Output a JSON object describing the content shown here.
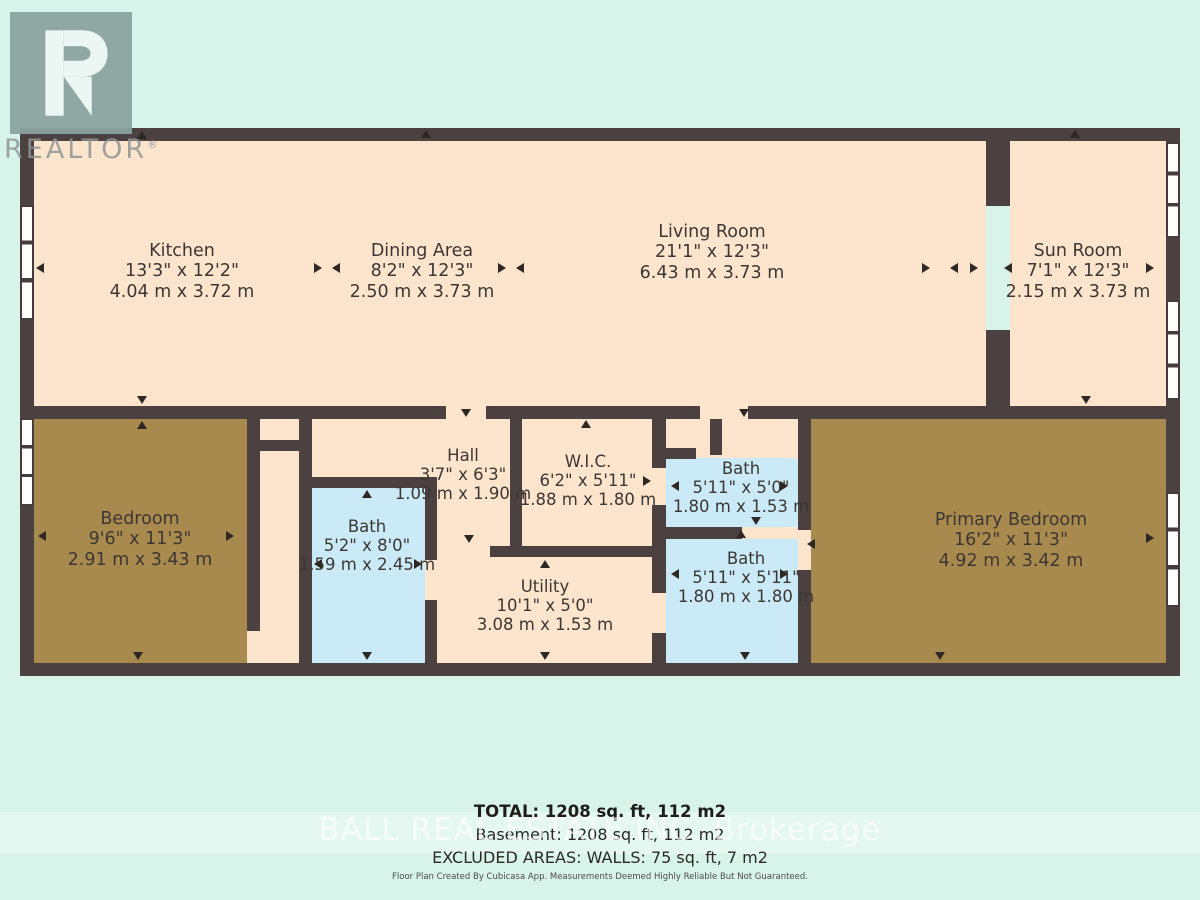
{
  "branding": {
    "logo_text": "R",
    "logo_label": "REALTOR",
    "logo_reg": "®",
    "watermark": "BALL REAL ESTATE INC. Brokerage"
  },
  "rooms": [
    {
      "name": "Kitchen",
      "imperial": "13'3\" x 12'2\"",
      "metric": "4.04 m x 3.72 m"
    },
    {
      "name": "Dining Area",
      "imperial": "8'2\" x 12'3\"",
      "metric": "2.50 m x 3.73 m"
    },
    {
      "name": "Living Room",
      "imperial": "21'1\" x 12'3\"",
      "metric": "6.43 m x 3.73 m"
    },
    {
      "name": "Sun Room",
      "imperial": "7'1\" x 12'3\"",
      "metric": "2.15 m x 3.73 m"
    },
    {
      "name": "Bedroom",
      "imperial": "9'6\" x 11'3\"",
      "metric": "2.91 m x 3.43 m"
    },
    {
      "name": "Hall",
      "imperial": "3'7\" x 6'3\"",
      "metric": "1.09 m x 1.90 m"
    },
    {
      "name": "W.I.C.",
      "imperial": "6'2\" x 5'11\"",
      "metric": "1.88 m x 1.80 m"
    },
    {
      "name": "Bath",
      "imperial": "5'11\" x 5'0\"",
      "metric": "1.80 m x 1.53 m"
    },
    {
      "name": "Bath",
      "imperial": "5'2\" x 8'0\"",
      "metric": "1.59 m x 2.45 m"
    },
    {
      "name": "Bath",
      "imperial": "5'11\" x 5'11\"",
      "metric": "1.80 m x 1.80 m"
    },
    {
      "name": "Utility",
      "imperial": "10'1\" x 5'0\"",
      "metric": "3.08 m x 1.53 m"
    },
    {
      "name": "Primary Bedroom",
      "imperial": "16'2\" x 11'3\"",
      "metric": "4.92 m x 3.42 m"
    }
  ],
  "summary": {
    "total": "TOTAL: 1208 sq. ft, 112 m2",
    "basement": "Basement: 1208 sq. ft, 112 m2",
    "excluded": "EXCLUDED AREAS: WALLS: 75 sq. ft, 7 m2",
    "disclaimer": "Floor Plan Created By Cubicasa App. Measurements Deemed Highly Reliable But Not Guaranteed."
  },
  "colors": {
    "background": "#d8f4ea",
    "wall": "#4a4140",
    "room_default": "#fce4cd",
    "bath": "#cbeaf7",
    "bedroom": "#a98a4e",
    "watermark_band": "#ffffff"
  }
}
